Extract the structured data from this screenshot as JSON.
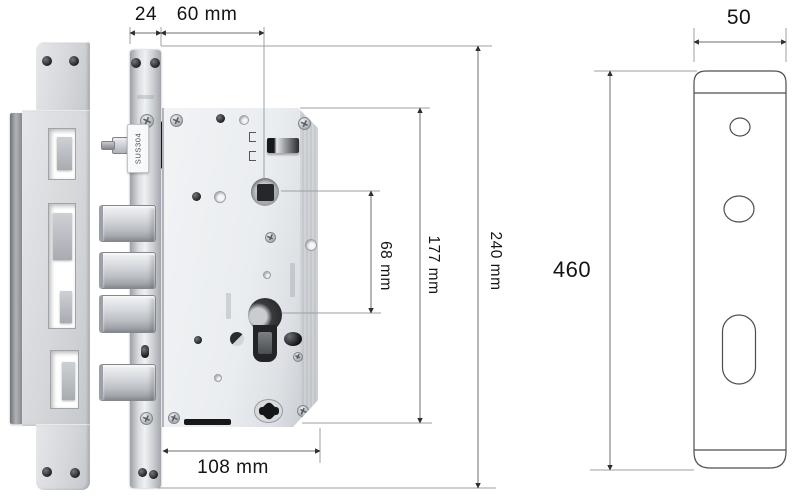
{
  "diagram": {
    "title_hint": "mortise-lock-dimension-diagram",
    "dimensions": {
      "faceplate_width": "24",
      "backset": "60 mm",
      "center_distance": "68 mm",
      "body_height": "177 mm",
      "faceplate_height": "240 mm",
      "body_depth": "108 mm",
      "back_panel_width": "50",
      "back_panel_height": "460"
    },
    "markings": {
      "faceplate_steel_grade": "SUS304"
    }
  },
  "colors": {
    "text": "#1b1b1b",
    "dim_line": "#8f9397",
    "arrow": "#2f2f2f",
    "outline": "#4d4d4d",
    "metal_light": "#eff1f3",
    "metal_mid": "#c9ccd1",
    "metal_dark": "#8f9296"
  }
}
